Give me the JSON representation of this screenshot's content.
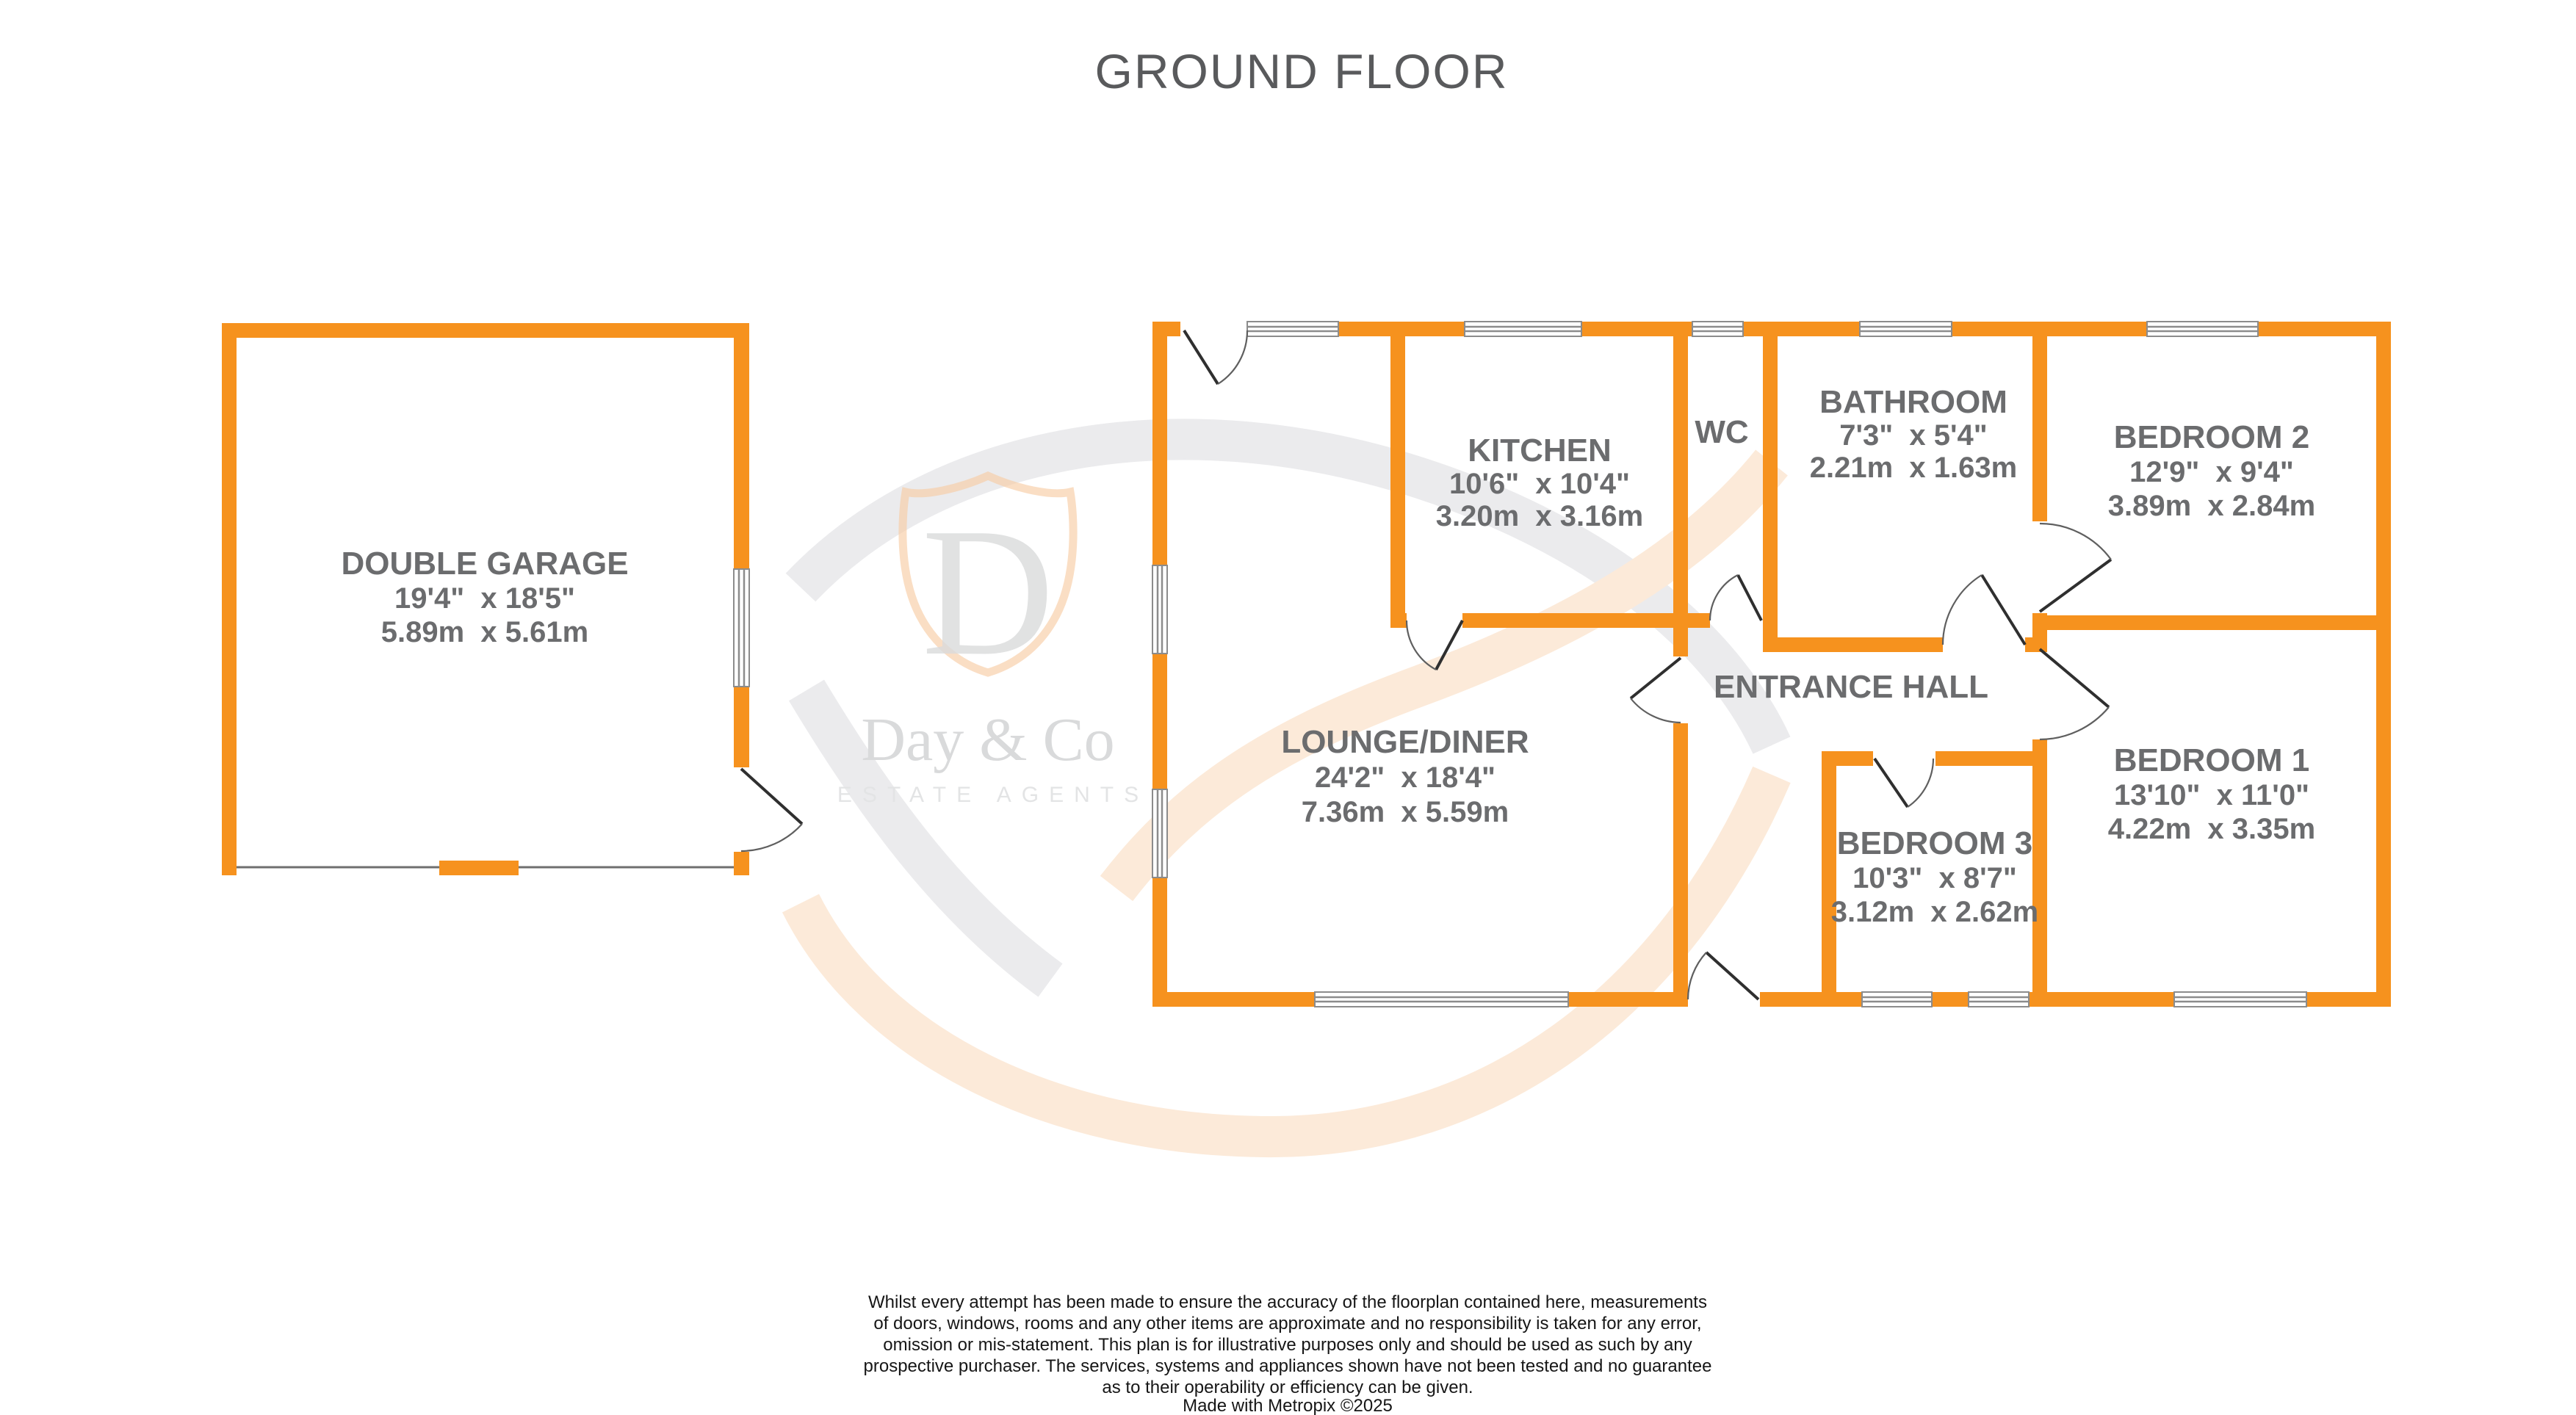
{
  "title": "GROUND FLOOR",
  "colors": {
    "wall_orange": "#F6921E",
    "label_gray": "#6B6C6E",
    "title_gray": "#595A5C",
    "watermark_peach": "#f7cda4",
    "watermark_gray": "#dadbdc"
  },
  "rooms": {
    "garage": {
      "name": "DOUBLE GARAGE",
      "imperial": "19'4\"  x 18'5\"",
      "metric": "5.89m  x 5.61m"
    },
    "kitchen": {
      "name": "KITCHEN",
      "imperial": "10'6\"  x 10'4\"",
      "metric": "3.20m  x 3.16m"
    },
    "wc": {
      "name": "WC"
    },
    "bathroom": {
      "name": "BATHROOM",
      "imperial": "7'3\"  x 5'4\"",
      "metric": "2.21m  x 1.63m"
    },
    "bedroom2": {
      "name": "BEDROOM 2",
      "imperial": "12'9\"  x 9'4\"",
      "metric": "3.89m  x 2.84m"
    },
    "lounge": {
      "name": "LOUNGE/DINER",
      "imperial": "24'2\"  x 18'4\"",
      "metric": "7.36m  x 5.59m"
    },
    "hall": {
      "name": "ENTRANCE HALL"
    },
    "bedroom3": {
      "name": "BEDROOM 3",
      "imperial": "10'3\"  x 8'7\"",
      "metric": "3.12m  x 2.62m"
    },
    "bedroom1": {
      "name": "BEDROOM 1",
      "imperial": "13'10\"  x 11'0\"",
      "metric": "4.22m  x 3.35m"
    }
  },
  "watermark": {
    "initial": "D",
    "brand": "Day & Co",
    "tagline": "ESTATE AGENTS"
  },
  "disclaimer": {
    "lines": [
      "Whilst every attempt has been made to ensure the accuracy of the floorplan contained here, measurements",
      "of doors, windows, rooms and any other items are approximate and no responsibility is taken for any error,",
      "omission or mis-statement. This plan is for illustrative purposes only and should be used as such by any",
      "prospective purchaser. The services, systems and appliances shown have not been tested and no guarantee",
      "as to their operability or efficiency can be given."
    ],
    "credit": "Made with Metropix ©2025"
  }
}
